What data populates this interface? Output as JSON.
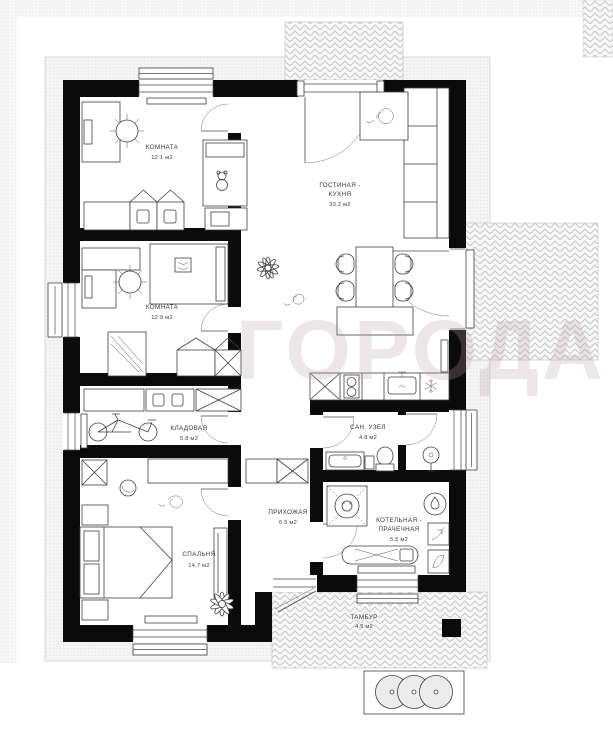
{
  "watermark": {
    "text": "ГОРОДА"
  },
  "rooms": {
    "room1": {
      "name": "КОМНАТА",
      "area": "12.1 м2"
    },
    "living": {
      "name_line1": "ГОСТИНАЯ -",
      "name_line2": "КУХНЯ",
      "area": "33.2 м2"
    },
    "room2": {
      "name": "КОМНАТА",
      "area": "12.9 м2"
    },
    "storage": {
      "name": "КЛАДОВАЯ",
      "area": "5.8 м2"
    },
    "bathroom": {
      "name": "САН. УЗЕЛ",
      "area": "4.8 м2"
    },
    "hallway": {
      "name": "ПРИХОЖАЯ",
      "area": "6.5 м2"
    },
    "boiler": {
      "name_line1": "КОТЕЛЬНАЯ -",
      "name_line2": "ПРАЧЕЧНАЯ",
      "area": "5.5 м2"
    },
    "bedroom": {
      "name": "СПАЛЬНЯ",
      "area": "14.7 м2"
    },
    "vestibule": {
      "name": "ТАМБУР",
      "area": "4.5 м2"
    }
  },
  "colors": {
    "wall": "#0b0b0b",
    "furniture_line": "#3f3f3f",
    "hatch_line": "#c6c6c6",
    "band_fill": "#f4f4f4",
    "watermark": "rgba(185,160,160,0.26)",
    "label_text": "#353535"
  }
}
